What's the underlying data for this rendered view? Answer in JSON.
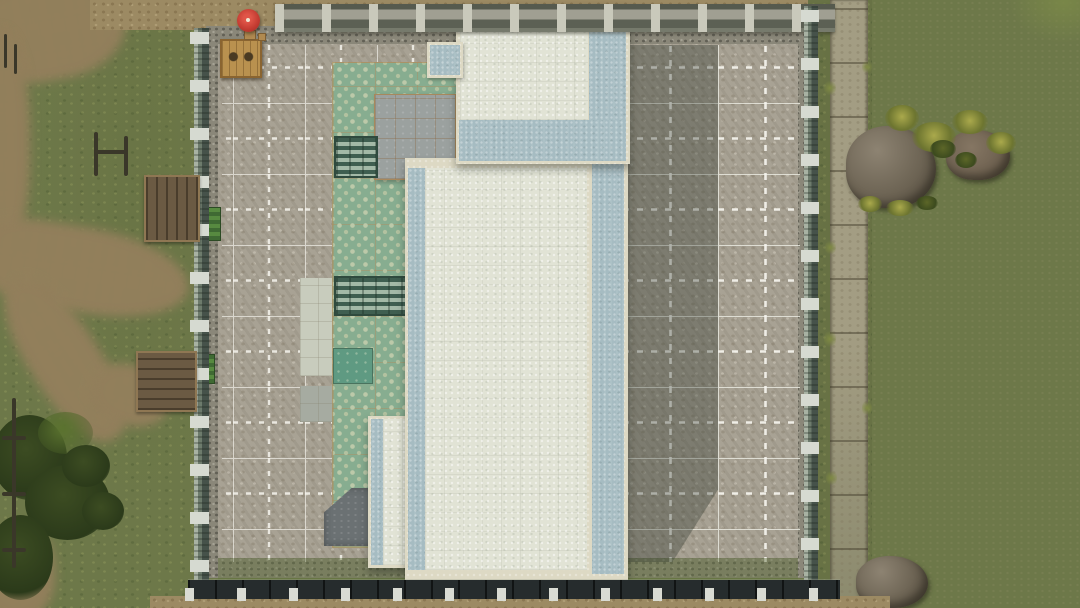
{
  "scene": {
    "name": "top-down-park-compound",
    "description": "Top-down aerial game view of a square fenced compound containing a large pale-roofed building complex, polka-dot flooring and gravel ground marked with a white construction grid; grass and dirt paths on the left, a stone walkway, rocks and murky green water on the right.",
    "camera": "orthographic top-down",
    "visible_text": "none"
  },
  "palette": {
    "grass": "#6d7849",
    "dirt": "#93805c",
    "water_light": "#5a6941",
    "water_dark": "#384a2d",
    "gravel": "#a8a294",
    "pebble_border": "#8a8779",
    "grid_line": "#efeee6",
    "polka_base": "#87ad90",
    "polka_dot": "#bcc9a9",
    "roof_pale": "#e1e3d5",
    "roof_blue": "#a6bcc2",
    "roof_trim_cream": "#ddd9c4",
    "tile_roof_gray": "#9ba19f",
    "teal_pad": "#5f9a82",
    "stone_path": "#a39d83",
    "fence_green_gray": "#6d7b6c",
    "post_white": "#d6dad1",
    "south_wall_dark": "#262c2d",
    "deck_wood": "#6b5a43",
    "crate_wood": "#b9914f",
    "umbrella_red": "#c23b31",
    "rock_gray": "#6d6454"
  },
  "grid": {
    "style": "solid white square grid with brighter dashed half-lines",
    "left_cell_px": [
      72,
      71
    ],
    "right_cell_px": [
      95,
      71
    ],
    "covers": "gravel floor inside compound, left and right of the building"
  },
  "counts": {
    "left_fence_posts": 12,
    "right_fence_posts": 12,
    "south_wall_posts": 13,
    "balustrade_pillars": 12,
    "wooden_decks": 2,
    "rocks_top_right": 2
  },
  "objects": {
    "viewport": {
      "name": "game world viewport"
    },
    "main_building": {
      "name": "main building - large pale roof with blue-gray side bands"
    },
    "tower_roof": {
      "name": "north building section - pale roof with blue band"
    },
    "annex": {
      "name": "small blue-roofed annex"
    },
    "side_roof": {
      "name": "west low roof strip"
    },
    "tile_roof": {
      "name": "gray tiled roof hut"
    },
    "wedge_roof": {
      "name": "dark angled roof piece"
    },
    "polka_floor": {
      "name": "sage polka-dot flooring"
    },
    "teal_pad_obj": {
      "name": "teal floor pad"
    },
    "mat_upper": {
      "name": "striped mat (upper)"
    },
    "mat_lower": {
      "name": "striped mat (lower)"
    },
    "concrete_pads": {
      "name": "concrete floor pads"
    },
    "umbrella": {
      "name": "red parasol with table"
    },
    "crate": {
      "name": "wooden vendor crate"
    },
    "deck_north": {
      "name": "wooden viewing deck (north-west)"
    },
    "deck_south": {
      "name": "wooden viewing deck (south-west)"
    },
    "planter_north": {
      "name": "green planter bench (north)"
    },
    "planter_south": {
      "name": "green planter bench (south)"
    },
    "left_fence": {
      "name": "west glass-panel fence with posts"
    },
    "right_fence": {
      "name": "east glass-panel fence with posts"
    },
    "south_wall": {
      "name": "south dark plank wall with posts"
    },
    "balustrade": {
      "name": "north stone balustrade with pillars"
    },
    "pebble_frame": {
      "name": "pebble border inside fence"
    },
    "gravel_floor": {
      "name": "gravel habitat floor"
    },
    "grid_overlay": {
      "name": "white construction grid"
    },
    "shadow": {
      "name": "building shadow on gravel"
    },
    "stone_path": {
      "name": "stone slab walkway"
    },
    "water": {
      "name": "murky green water"
    },
    "rocks": {
      "name": "rock outcrop with grass tufts"
    },
    "rock_south": {
      "name": "rock outcrop (south-east)"
    },
    "grass_field": {
      "name": "grass field"
    },
    "dirt_paths": {
      "name": "worn dirt paths"
    },
    "bushes": {
      "name": "bush cluster"
    },
    "pole_fence": {
      "name": "rustic wooden pole fence"
    },
    "dirt_road_south": {
      "name": "sandy track (south)"
    },
    "dirt_road_north": {
      "name": "sandy ground (north)"
    }
  }
}
